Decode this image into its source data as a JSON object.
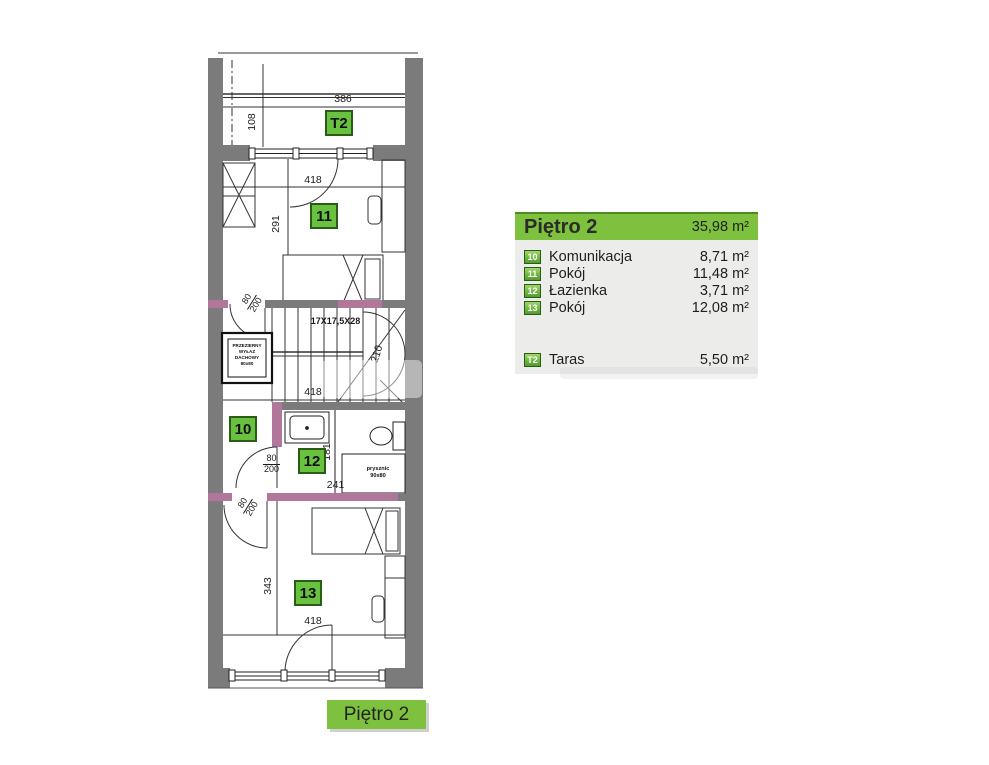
{
  "plan": {
    "badges": {
      "t2": "T2",
      "r10": "10",
      "r11": "11",
      "r12": "12",
      "r13": "13"
    },
    "dims": {
      "terrace_width": "386",
      "terrace_depth": "108",
      "room11_width": "418",
      "room11_height": "291",
      "stairs_formula": "17X17,5X28",
      "stairs_height": "210",
      "stairs_width": "418",
      "door_width": "80",
      "door_height": "200",
      "bath_height": "181",
      "bath_width": "241",
      "room13_height": "343",
      "room13_width": "418"
    },
    "skylight": {
      "line1": "PRZEZIERNY",
      "line2": "WYŁAZ",
      "line3": "DACHOWY",
      "line4": "80x80"
    },
    "shower": {
      "line1": "prysznic",
      "line2": "90x80"
    }
  },
  "legend": {
    "title": "Piętro 2",
    "total_area": "35,98 m²",
    "rooms": [
      {
        "id": "10",
        "name": "Komunikacja",
        "area": "8,71 m²"
      },
      {
        "id": "11",
        "name": "Pokój",
        "area": "11,48 m²"
      },
      {
        "id": "12",
        "name": "Łazienka",
        "area": "3,71 m²"
      },
      {
        "id": "13",
        "name": "Pokój",
        "area": "12,08 m²"
      }
    ],
    "extra": {
      "id": "T2",
      "name": "Taras",
      "area": "5,50 m²"
    }
  },
  "footer": {
    "label": "Piętro 2"
  },
  "colors": {
    "accent_green": "#7dc13e",
    "badge_green": "#68c13f",
    "badge_border_green": "#2a5c15",
    "wall_gray": "#7b7b7b",
    "lintel_purple": "#b0779b",
    "panel_bg": "#ecedea"
  }
}
